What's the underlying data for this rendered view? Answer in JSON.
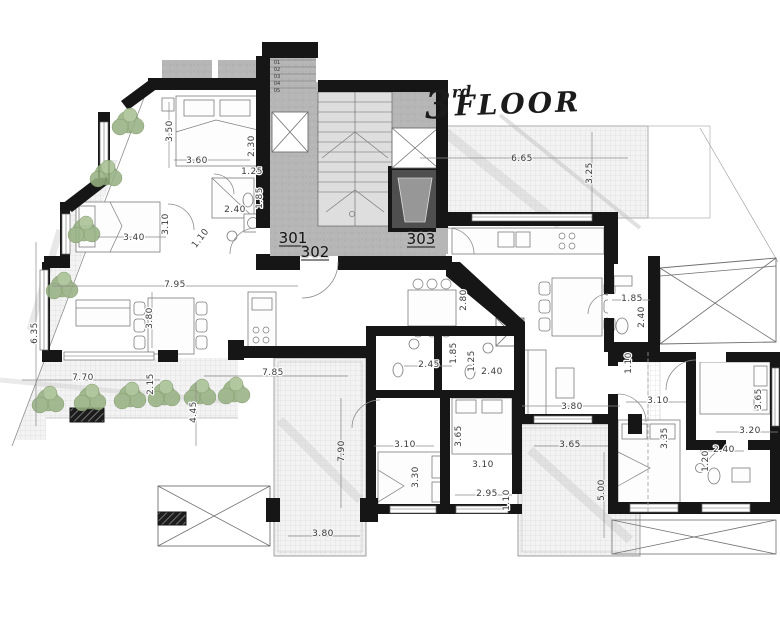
{
  "title": {
    "floor_number": "3",
    "ordinal_suffix": "rd",
    "floor_word": "FLOOR"
  },
  "units": {
    "unit_301": "301",
    "unit_302": "302",
    "unit_303": "303"
  },
  "stair_steps": [
    "01",
    "02",
    "03",
    "04",
    "05"
  ],
  "dimensions": [
    "3.50",
    "3.60",
    "1.25",
    "2.30",
    "2.40",
    "1.85",
    "3.40",
    "3.10",
    "1.10",
    "7.95",
    "3.80",
    "6.35",
    "7.70",
    "2.15",
    "4.45",
    "7.85",
    "2.80",
    "2.45",
    "1.85",
    "1.25",
    "2.40",
    "6.65",
    "3.25",
    "1.85",
    "2.40",
    "1.10",
    "7.90",
    "3.10",
    "3.30",
    "3.65",
    "3.10",
    "2.95",
    "1.10",
    "3.80",
    "3.80",
    "3.65",
    "5.00",
    "3.10",
    "3.35",
    "3.65",
    "3.20",
    "2.40",
    "1.20"
  ],
  "colors": {
    "wall": "#161616",
    "concrete": "#b6b6b6",
    "tile_line": "#d4d4d4",
    "plant_green": "#97b183",
    "dim_text": "#3a3a3a"
  }
}
